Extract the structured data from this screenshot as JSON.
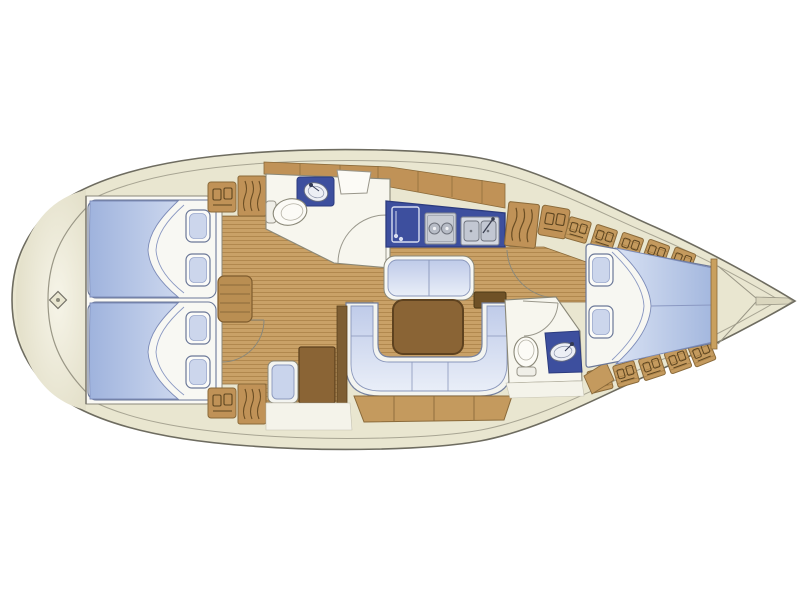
{
  "diagram": {
    "kind": "sailing-yacht-interior-floor-plan",
    "orientation": "bow-left-stern-right",
    "background": "#ffffff"
  },
  "colors": {
    "deck_cream": "#e9e6d0",
    "deck_edge": "#6e6c60",
    "deck_inner_line": "#a8a593",
    "floor_wood": "#c9a167",
    "floor_plank_line": "#ab8248",
    "cabinet_tan": "#c09257",
    "cabinet_outline": "#8a6a3a",
    "furniture_dark_wood": "#8a6435",
    "furniture_dark_outline": "#5e421f",
    "counter_navy": "#3d4f9e",
    "counter_navy_outline": "#2c3b7e",
    "upholstery_blue": "#9fb3dd",
    "upholstery_blue_light": "#dce5f5",
    "pillow_inner": "#ccd6ec",
    "fixture_white": "#f7f6ee",
    "fixture_outline": "#8a8878",
    "stove_gray": "#c8ccd4",
    "step_dark_wood": "#6f5126"
  },
  "regions": {
    "foredeck": {
      "features": [
        "anchor-windlass-diamond",
        "deck-seam-curve"
      ]
    },
    "forward_cabin": {
      "berths": 2,
      "pillows": 4,
      "lockers": [
        "shelf-locker",
        "hanging-locker",
        "shelf-locker",
        "hanging-locker"
      ],
      "furniture": [
        "dresser-steps"
      ]
    },
    "forward_head": {
      "fixtures": [
        "toilet",
        "washbasin-vanity",
        "counter-seat"
      ],
      "door": "swing-arc"
    },
    "galley": {
      "appliances": [
        "refrigerator",
        "two-burner-stove",
        "double-sink"
      ]
    },
    "saloon": {
      "furniture": [
        "forward-bench",
        "dining-table",
        "u-shaped-settee",
        "hull-locker-band"
      ]
    },
    "nav_station": {
      "furniture": [
        "chart-table",
        "navigator-seat"
      ]
    },
    "companionway": {
      "features": [
        "step-box",
        "hanging-locker",
        "shelf-locker",
        "door-swing-arc"
      ]
    },
    "aft_head": {
      "fixtures": [
        "toilet",
        "washbasin-vanity"
      ],
      "door": "swing-arc"
    },
    "aft_cabin": {
      "berths": 1,
      "pillows": 2,
      "hull_lockers": 10
    },
    "stern": {
      "features": [
        "transom-cone",
        "centerline-spine"
      ]
    }
  }
}
